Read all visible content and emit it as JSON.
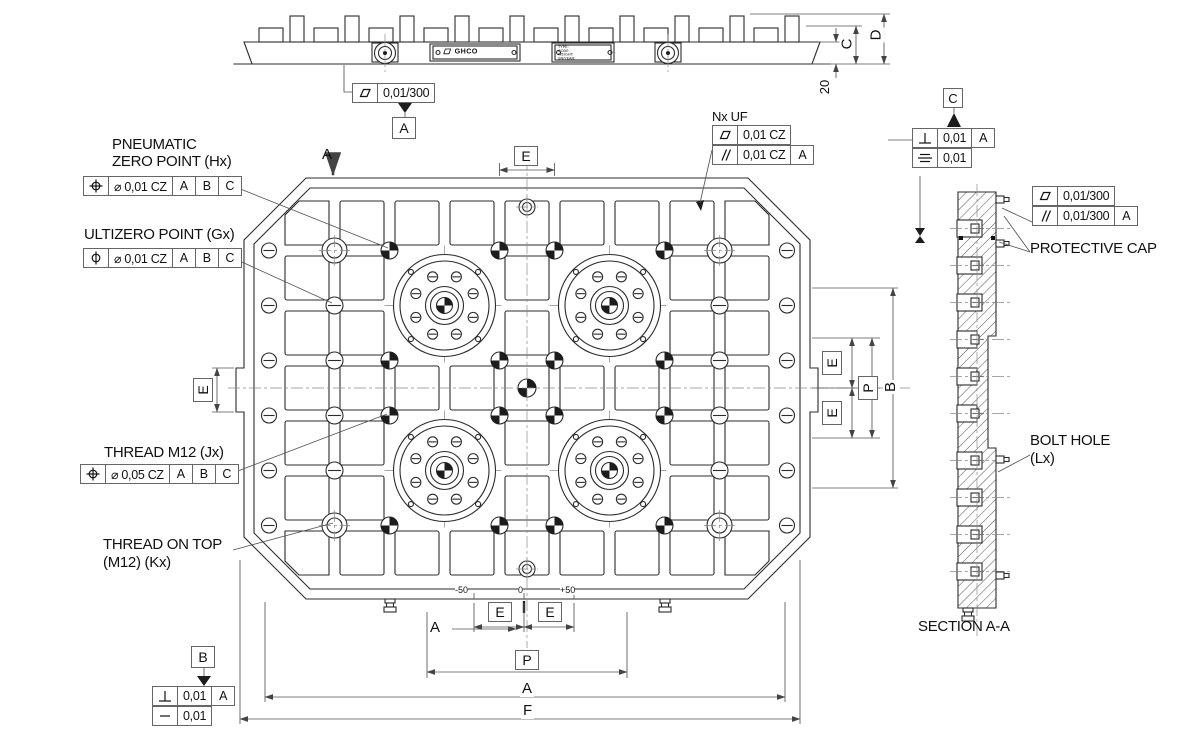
{
  "labels": {
    "pneumatic1": "PNEUMATIC",
    "pneumatic2": "ZERO POINT (Hx)",
    "ultizero": "ULTIZERO POINT (Gx)",
    "thread_m12": "THREAD M12 (Jx)",
    "thread_top1": "THREAD ON TOP",
    "thread_top2": "(M12) (Kx)",
    "nx_uf": "Nx UF",
    "protective_cap": "PROTECTIVE CAP",
    "bolt_hole1": "BOLT HOLE",
    "bolt_hole2": "(Lx)",
    "section_title": "SECTION A-A"
  },
  "fcf": {
    "pneumatic": {
      "tol": "⌀ 0,01 CZ",
      "d1": "A",
      "d2": "B",
      "d3": "C"
    },
    "ultizero": {
      "tol": "⌀ 0,01 CZ",
      "d1": "A",
      "d2": "B",
      "d3": "C"
    },
    "thread": {
      "tol": "⌀ 0,05 CZ",
      "d1": "A",
      "d2": "B",
      "d3": "C"
    },
    "nx_uf": {
      "row1_tol": "0,01 CZ",
      "row2_tol": "0,01 CZ",
      "row2_datum": "A"
    },
    "datum_c": {
      "row1_tol": "0,01",
      "row1_datum": "A",
      "row2_tol": "0,01"
    },
    "section": {
      "row1_tol": "0,01/300",
      "row2_tol": "0,01/300",
      "row2_datum": "A"
    },
    "datum_b": {
      "row1_tol": "0,01",
      "row1_datum": "A",
      "row2_tol": "0,01"
    },
    "top_flatness": {
      "tol": "0,01/300"
    }
  },
  "datums": {
    "a": "A",
    "b": "B",
    "c": "C"
  },
  "dims": {
    "c": "C",
    "d": "D",
    "t20": "20",
    "e": "E",
    "p": "P",
    "a": "A",
    "b": "B",
    "f": "F"
  },
  "ticks": {
    "minus": "-50",
    "zero": "0",
    "plus": "+50"
  },
  "section_marks": {
    "top": "A",
    "bottom": "A"
  },
  "nameplate": {
    "l1": "TYPE:",
    "l2": "CODE:",
    "l3": "WEIGHT:",
    "l4": "SN/YEAR:",
    "logo": "GHCO"
  }
}
